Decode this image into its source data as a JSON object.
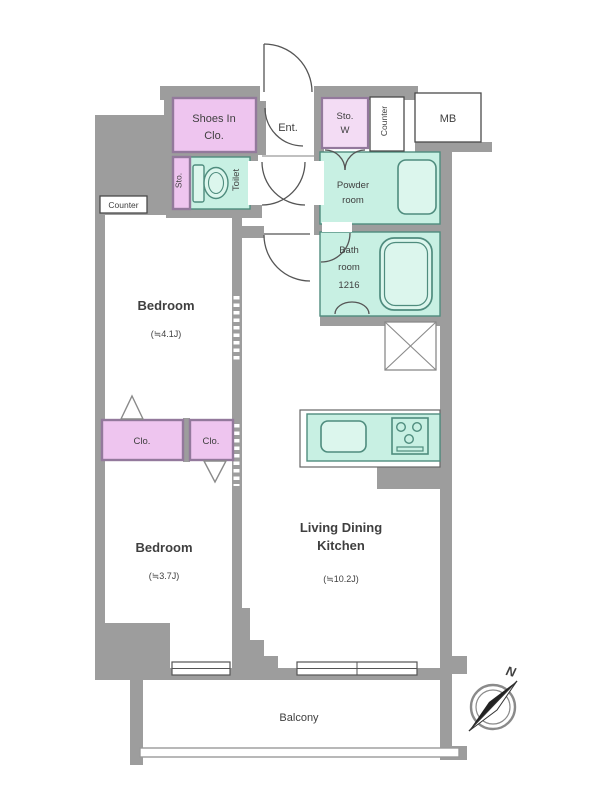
{
  "colors": {
    "wall": "#9d9d9d",
    "room_teal": "#c8f0e3",
    "fixture_teal": "#dcf6ed",
    "teal_line": "#4f8c7e",
    "closet_pink": "#eec5ef",
    "storage_pink": "#f3dcf4",
    "pink_line": "#93799c",
    "line_dark": "#555555",
    "box_border": "#4a4a4a",
    "text": "#3f3f3f"
  },
  "rooms": {
    "shoes_in_closet": {
      "line1": "Shoes In",
      "line2": "Clo."
    },
    "entrance": {
      "label": "Ent."
    },
    "storage_w": {
      "line1": "Sto.",
      "line2": "W"
    },
    "counter_top": {
      "label": "Counter"
    },
    "meter_box": {
      "label": "MB"
    },
    "storage_small": {
      "label": "Sto."
    },
    "toilet": {
      "label": "Toilet"
    },
    "powder_room": {
      "line1": "Powder",
      "line2": "room"
    },
    "bathroom": {
      "line1": "Bath",
      "line2": "room",
      "line3": "1216"
    },
    "counter_left": {
      "label": "Counter"
    },
    "bedroom_upper": {
      "label": "Bedroom",
      "area": "(≒4.1J)"
    },
    "closet_large": {
      "label": "Clo."
    },
    "closet_small": {
      "label": "Clo."
    },
    "bedroom_lower": {
      "label": "Bedroom",
      "area": "(≒3.7J)"
    },
    "ldk": {
      "line1": "Living Dining",
      "line2": "Kitchen",
      "area": "(≒10.2J)"
    },
    "balcony": {
      "label": "Balcony"
    }
  },
  "compass": {
    "north_label": "N"
  }
}
